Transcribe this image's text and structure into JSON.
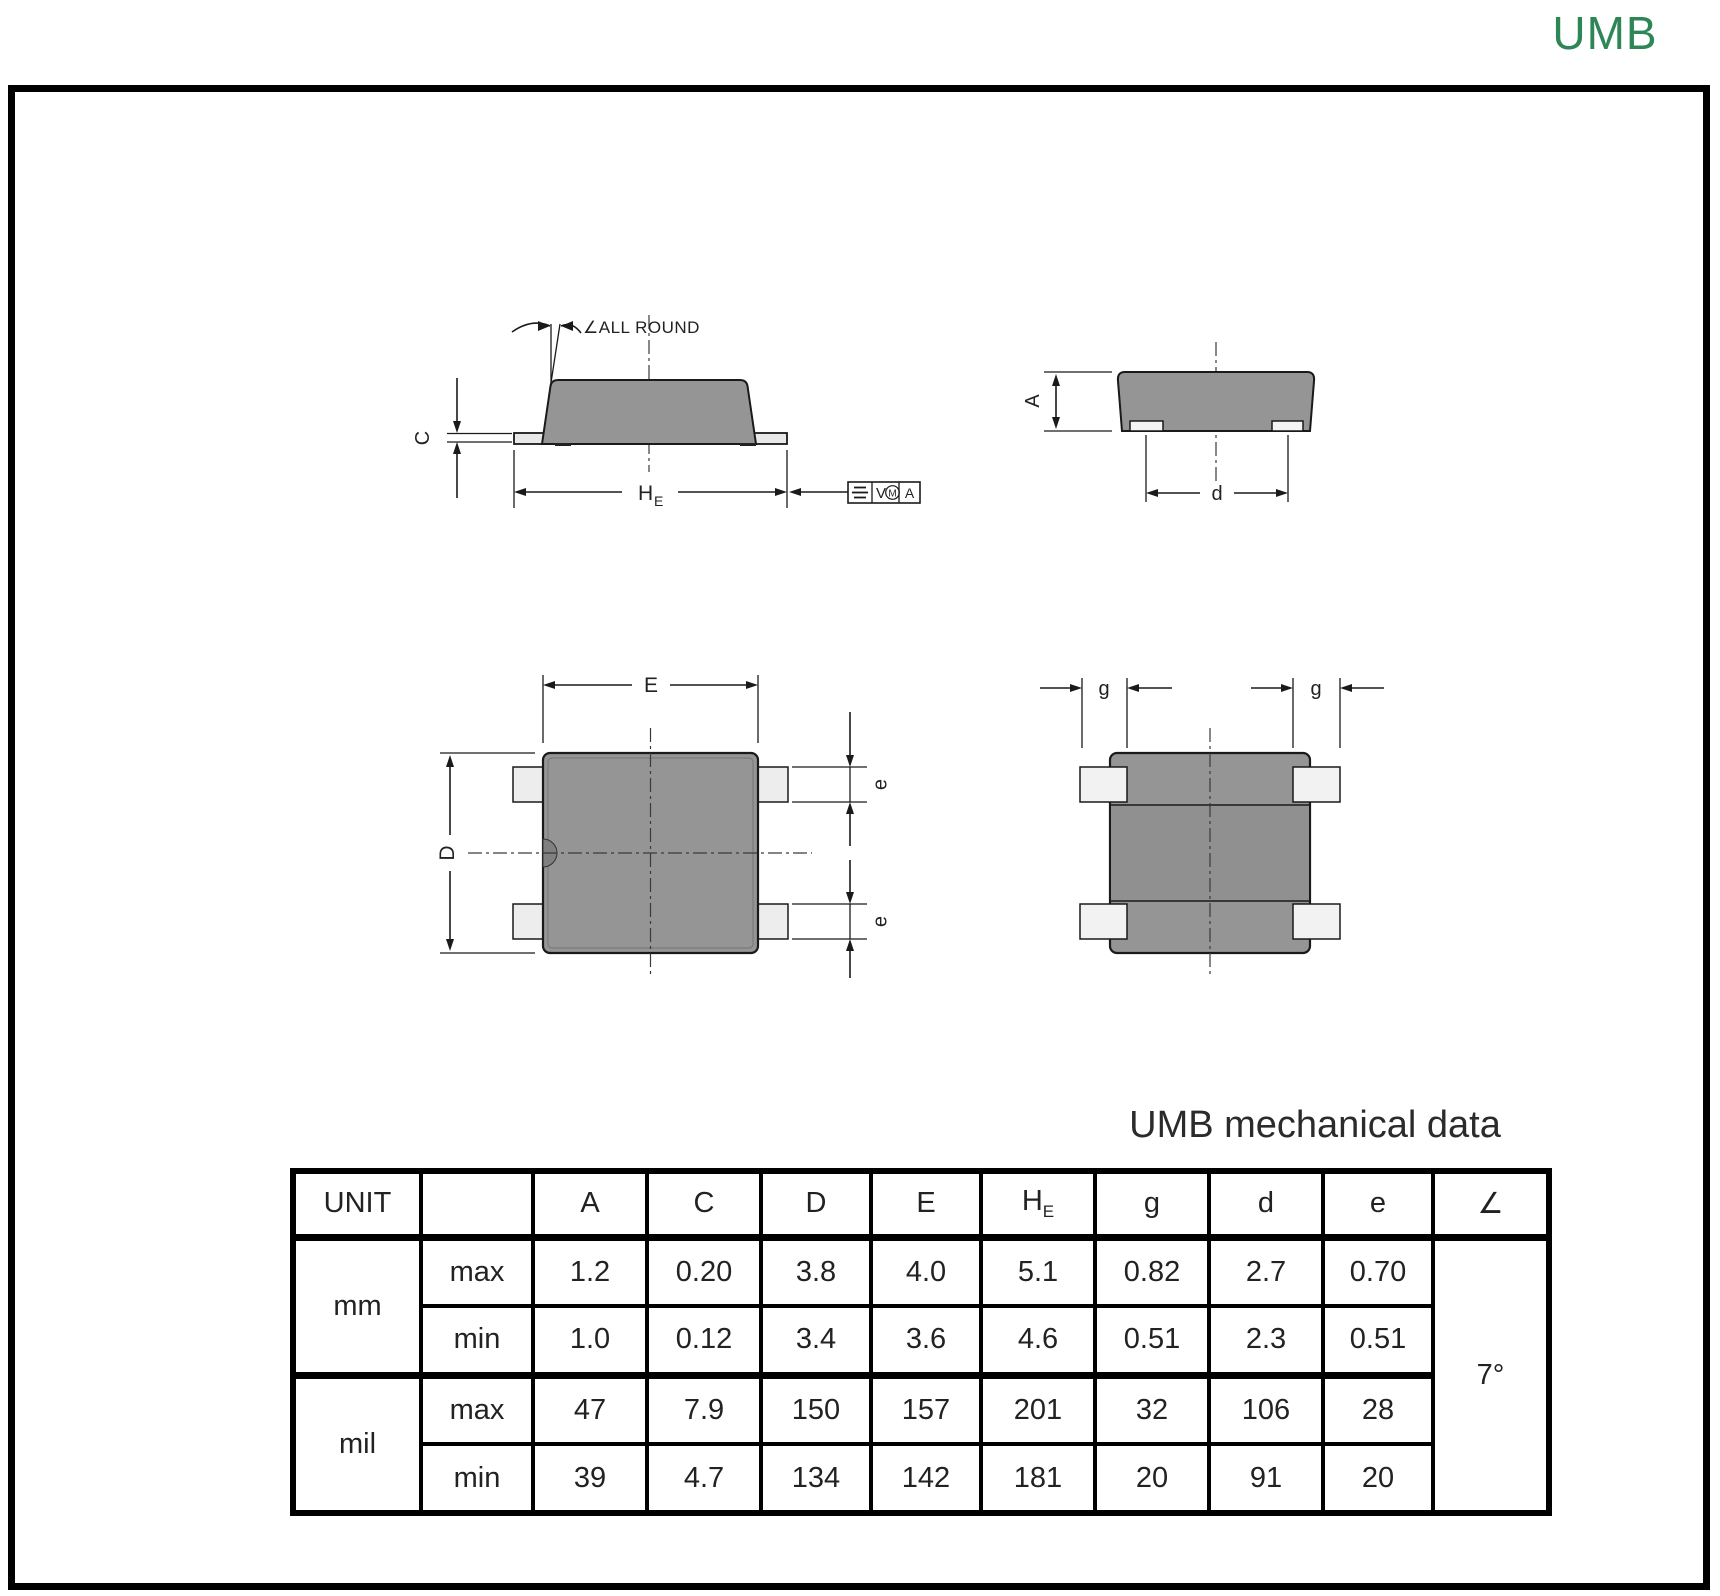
{
  "page": {
    "title": "UMB",
    "accent_color": "#2e8656"
  },
  "drawings": {
    "side_view": {
      "angle_note": "∠ALL ROUND",
      "dim_thickness": "C",
      "dim_width_main": "H",
      "dim_width_sub": "E",
      "tolerance_frame": {
        "zone": "V",
        "modifier": "M",
        "datum": "A"
      }
    },
    "end_view": {
      "dim_height": "A",
      "dim_lead_span": "d"
    },
    "top_view": {
      "dim_body_width": "E",
      "dim_body_length": "D",
      "dim_lead_width_top": "e",
      "dim_lead_width_bottom": "e"
    },
    "bottom_view": {
      "dim_lead_length_left": "g",
      "dim_lead_length_right": "g"
    }
  },
  "table": {
    "title": "UMB mechanical data",
    "headers": {
      "unit": "UNIT",
      "blank": "",
      "a": "A",
      "c": "C",
      "d_cap": "D",
      "e_cap": "E",
      "he_main": "H",
      "he_sub": "E",
      "g": "g",
      "d": "d",
      "e": "e",
      "angle": "∠"
    },
    "groups": [
      {
        "unit": "mm",
        "rows": [
          {
            "label": "max",
            "values": [
              "1.2",
              "0.20",
              "3.8",
              "4.0",
              "5.1",
              "0.82",
              "2.7",
              "0.70"
            ]
          },
          {
            "label": "min",
            "values": [
              "1.0",
              "0.12",
              "3.4",
              "3.6",
              "4.6",
              "0.51",
              "2.3",
              "0.51"
            ]
          }
        ]
      },
      {
        "unit": "mil",
        "rows": [
          {
            "label": "max",
            "values": [
              "47",
              "7.9",
              "150",
              "157",
              "201",
              "32",
              "106",
              "28"
            ]
          },
          {
            "label": "min",
            "values": [
              "39",
              "4.7",
              "134",
              "142",
              "181",
              "20",
              "91",
              "20"
            ]
          }
        ]
      }
    ],
    "angle_value": "7°"
  }
}
